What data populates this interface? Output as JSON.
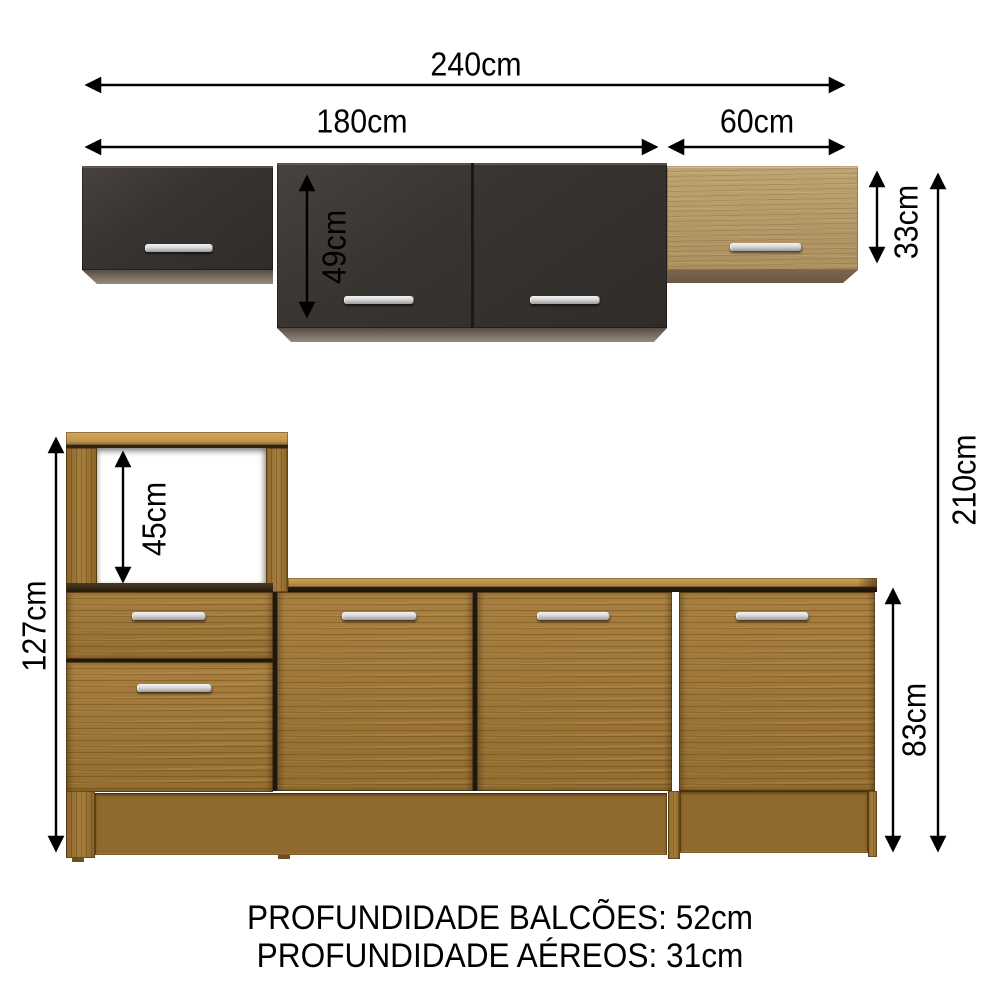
{
  "diagram": {
    "product": "kitchen-cabinet-set-dimension-diagram",
    "unit": "cm",
    "dimensions": {
      "total_width": {
        "label": "240cm",
        "value": 240
      },
      "upper_left_section_width": {
        "label": "180cm",
        "value": 180
      },
      "upper_right_section_width": {
        "label": "60cm",
        "value": 60
      },
      "upper_center_cabinet_height": {
        "label": "49cm",
        "value": 49
      },
      "upper_cabinet_height": {
        "label": "33cm",
        "value": 33
      },
      "total_height": {
        "label": "210cm",
        "value": 210
      },
      "tall_base_cabinet_height": {
        "label": "127cm",
        "value": 127
      },
      "oven_niche_height": {
        "label": "45cm",
        "value": 45
      },
      "base_cabinet_height": {
        "label": "83cm",
        "value": 83
      }
    },
    "footer": {
      "balcoes_depth": "PROFUNDIDADE BALCÕES: 52cm",
      "aereos_depth": "PROFUNDIDADE AÉREOS: 31cm"
    },
    "colors": {
      "background": "#ffffff",
      "annotation": "#000000",
      "dark_cabinet": "#38342f",
      "light_wood": "#b39767",
      "base_wood": "#9c7434",
      "countertop": "#bb8f49",
      "handle_silver": "#d9d9d9"
    }
  }
}
